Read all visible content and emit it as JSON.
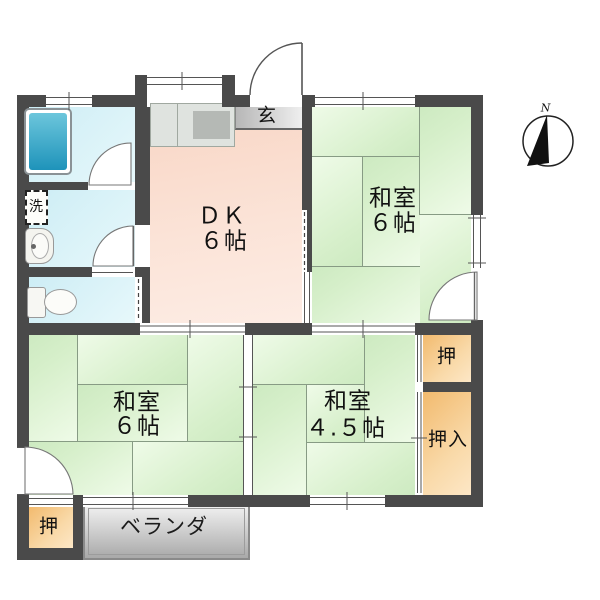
{
  "floorplan": {
    "rooms": {
      "dk": {
        "name": "ＤＫ",
        "size": "６帖"
      },
      "washitsu_ne": {
        "name": "和室",
        "size": "６帖"
      },
      "washitsu_sw": {
        "name": "和室",
        "size": "６帖"
      },
      "washitsu_se": {
        "name": "和室",
        "size": "４.５帖"
      },
      "genkan": {
        "label": "玄"
      },
      "laundry": {
        "label": "洗"
      },
      "veranda": {
        "label": "ベランダ"
      },
      "closet_ne": {
        "label": "押"
      },
      "closet_se": {
        "label": "押入"
      },
      "closet_sw": {
        "label": "押"
      }
    },
    "compass": {
      "north_label": "N"
    },
    "colors": {
      "wall": "#4a4a4a",
      "tatami": "#d9f0cd",
      "dk_floor": "#fadfd2",
      "wet_floor": "#d9f1f7",
      "closet": "#f7c98e",
      "bathtub": "#3ba7c9",
      "veranda": "#c9c9c9"
    }
  }
}
